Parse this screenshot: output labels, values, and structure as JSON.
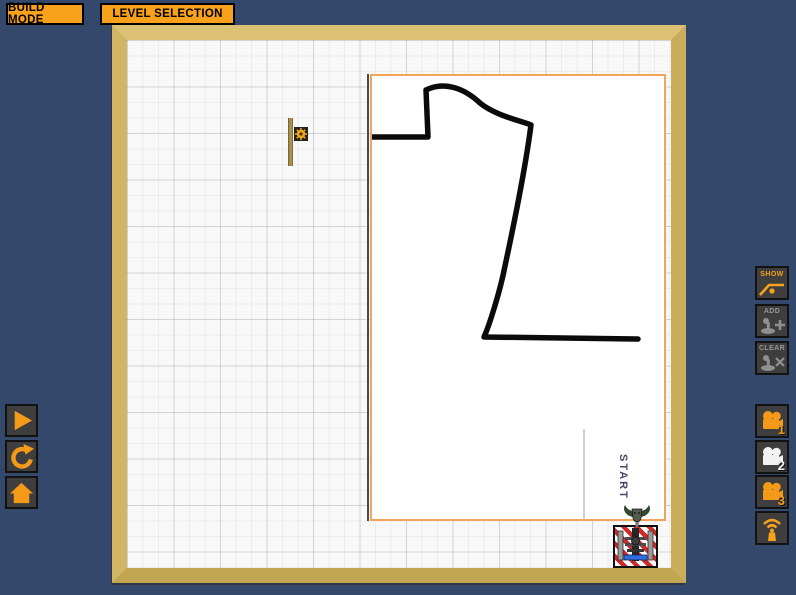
{
  "colors": {
    "background": "#33486B",
    "accent_orange": "#F9A11B",
    "wood_frame": "#D2B565",
    "level_border": "#F2A35C",
    "disabled_gray": "#969696",
    "active_camera": "#F2F2F2",
    "goal_stripe_red": "#CF2A2A",
    "goal_bar_blue": "#2F6EDE"
  },
  "top_bar": {
    "build_mode": "BUILD MODE",
    "level_selection": "LEVEL SELECTION"
  },
  "left_toolbar": {
    "buttons": [
      {
        "icon": "play-icon"
      },
      {
        "icon": "reset-icon"
      },
      {
        "icon": "home-icon"
      }
    ]
  },
  "right_toolbar": {
    "show_label": "SHOW",
    "add_label": "ADD",
    "clear_label": "CLEAR",
    "add_enabled": false,
    "clear_enabled": false,
    "cameras": [
      {
        "label": "1",
        "active": false
      },
      {
        "label": "2",
        "active": true
      },
      {
        "label": "3",
        "active": false
      }
    ],
    "transmitter_icon": "transmitter-icon"
  },
  "level": {
    "start_label": "START"
  },
  "icons": [
    "play-icon",
    "reset-icon",
    "home-icon",
    "show-path-icon",
    "pin-add-icon",
    "pin-clear-icon",
    "camera-icon",
    "transmitter-icon",
    "gear-pin-icon",
    "creature-icon",
    "goal-machine-icon"
  ]
}
